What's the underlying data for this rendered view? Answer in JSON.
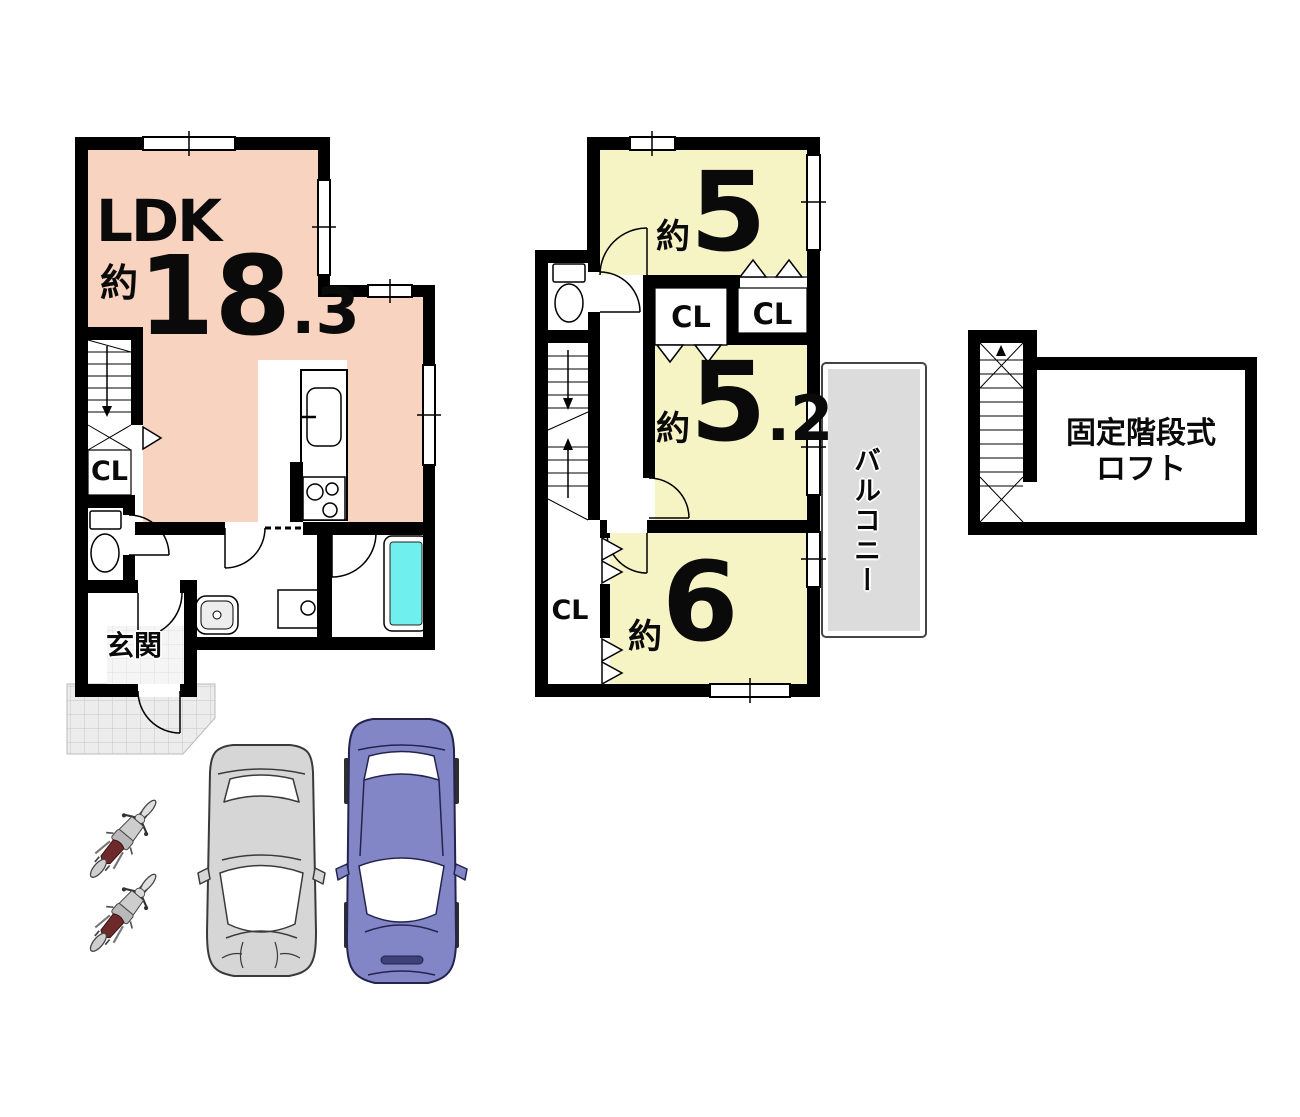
{
  "floor1": {
    "ldk": {
      "name": "LDK",
      "approx": "約",
      "whole": "18",
      "decimal": ".3"
    },
    "closet_label": "CL",
    "entrance_label": "玄関"
  },
  "floor2": {
    "room_top": {
      "approx": "約",
      "whole": "5"
    },
    "room_mid": {
      "approx": "約",
      "whole": "5",
      "decimal": ".2"
    },
    "room_bottom": {
      "approx": "約",
      "whole": "6"
    },
    "closet_left": "CL",
    "closet_right": "CL",
    "closet_bottom": "CL",
    "balcony_label": "バルコニー"
  },
  "loft": {
    "line1": "固定階段式",
    "line2": "ロフト"
  },
  "colors": {
    "wall_black": "#000000",
    "room_pink": "#f8d3bf",
    "room_yellow": "#f6f3c5",
    "balcony_gray": "#dcdcdc",
    "bathtub_cyan": "#6ff0ee",
    "car_gray": "#d6d6d6",
    "car_purple": "#8286c7",
    "bike_seat": "#6e2a2a"
  }
}
